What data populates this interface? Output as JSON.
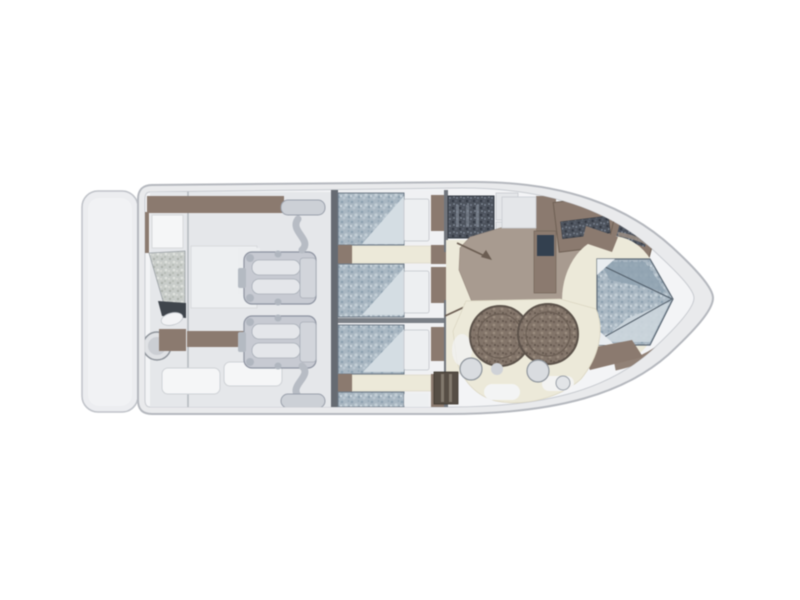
{
  "meta": {
    "description": "Top-down interior deck plan of a motor yacht, bow pointing right, no text labels",
    "background": "#ffffff"
  },
  "colors": {
    "hull_fill": "#e9eaec",
    "hull_stroke": "#b5b8be",
    "deck_fill": "#f3f4f6",
    "platform_fill": "#ecedf0",
    "platform_inner": "#f1f2f4",
    "cockpit_fill": "#e5e7ea",
    "cabin_floor": "#f0f1f3",
    "bulkhead": "#666b72",
    "bed_fold": "#d4dde3",
    "pillow": "#edeff1",
    "cream": "#ece9d9",
    "taupe_floor": "#a89b90",
    "wood": "#8b7a6f",
    "wood_dark": "#5f5149",
    "engine_body": "#c7cad2",
    "engine_pipe": "#b7bcc4",
    "muffler": "#ccd0d6",
    "screen_dark": "#33404f",
    "stool": "#d9dce0",
    "white_pad": "#f5f6f7",
    "step_block": "#564e45",
    "pale_block": "#e4e6e9",
    "table_edge": "#5c524a",
    "arrow": "#6b5d52",
    "hatch_stroke": "#343a43",
    "bed_stroke": "#6e7a86"
  },
  "plan": {
    "orientation": "bow-right",
    "areas": [
      {
        "id": "swim-platform"
      },
      {
        "id": "cockpit",
        "features": [
          "transom-seat",
          "sun-seat",
          "round-table",
          "benches"
        ]
      },
      {
        "id": "engine-room",
        "engines": 2
      },
      {
        "id": "guest-cabin-port",
        "berths": 2
      },
      {
        "id": "guest-cabin-starboard",
        "berths": 2
      },
      {
        "id": "head",
        "features": [
          "vanity-counter"
        ]
      },
      {
        "id": "salon",
        "features": [
          "door-swings",
          "tv-cabinet"
        ]
      },
      {
        "id": "galley",
        "features": [
          "counter",
          "locker"
        ]
      },
      {
        "id": "dinette",
        "tables": 2,
        "stools": 2
      },
      {
        "id": "v-berth-cabin",
        "berths": 1
      }
    ]
  }
}
